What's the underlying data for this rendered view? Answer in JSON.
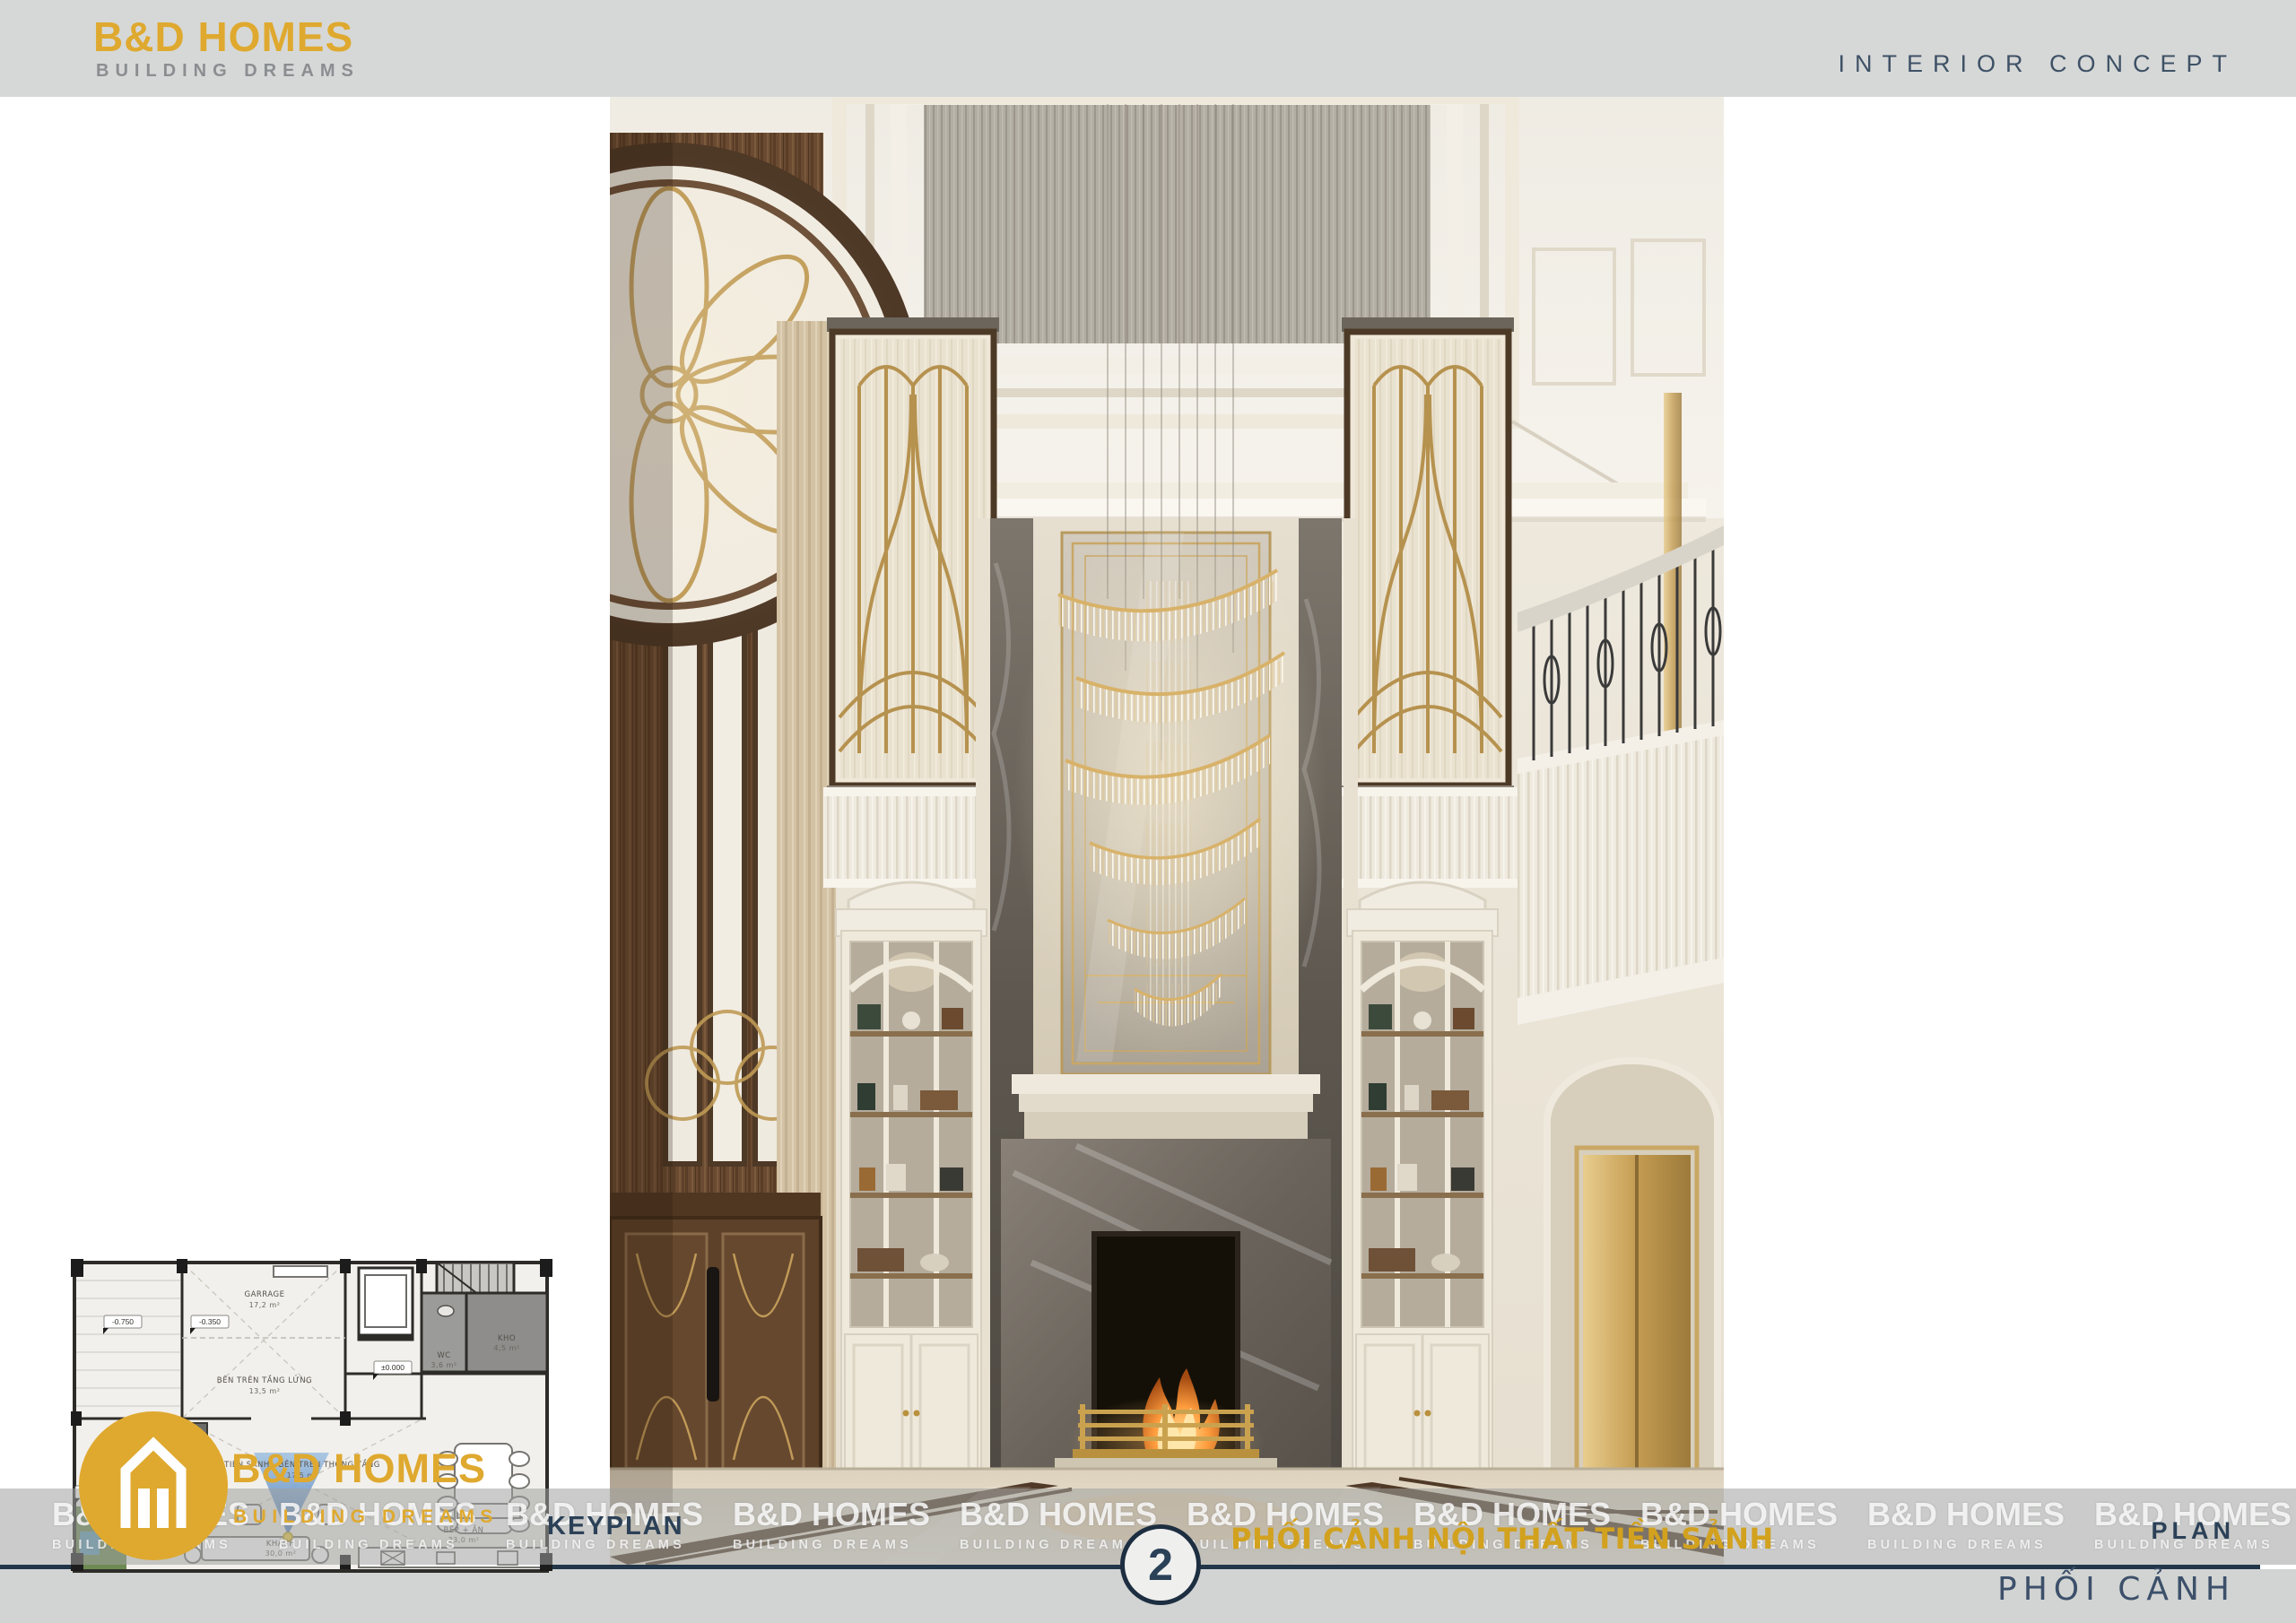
{
  "page": {
    "colors": {
      "header_bg": "#d6d8d7",
      "footer_bg": "#d2d4d3",
      "navy": "#2c4157",
      "logo_gold": "#dfa92f",
      "title_gold": "#d2a11e",
      "divider": "#22364a"
    }
  },
  "header": {
    "logo_name": "B&D HOMES",
    "logo_tagline": "BUILDING DREAMS",
    "concept_label": "INTERIOR CONCEPT"
  },
  "keyplan": {
    "rooms": [
      {
        "label": "GARRAGE",
        "area": "17,2 m²"
      },
      {
        "label": "BÊN TRÊN TẦNG LỬNG",
        "area": "13,5 m²"
      },
      {
        "label": "TIỀN SẢNH - BÊN TRÊN THÔNG TẦNG",
        "area": "17,5 m²"
      },
      {
        "label": "WC",
        "area": "3,6 m²"
      },
      {
        "label": "KHO",
        "area": "4,5 m²"
      },
      {
        "label": "KHÁCH",
        "area": "30,0 m²"
      },
      {
        "label": "BẾP + ĂN",
        "area": "33,0 m²"
      }
    ],
    "levels": [
      "-0.750",
      "-0.350",
      "±0.000",
      "-0.750"
    ],
    "logo_name": "B&D HOMES",
    "logo_tagline": "BUILDING DREAMS"
  },
  "footer": {
    "keyplan_label": "KEYPLAN",
    "sheet_number": "2",
    "title": "PHỐI CẢNH NỘI THẤT TIỀN SẢNH",
    "plan_label": "PLAN",
    "plan_caption": "PHỐI CẢNH",
    "watermark": {
      "line1": "B&D HOMES",
      "line2": "BUILDING DREAMS",
      "repeat": 10
    }
  }
}
